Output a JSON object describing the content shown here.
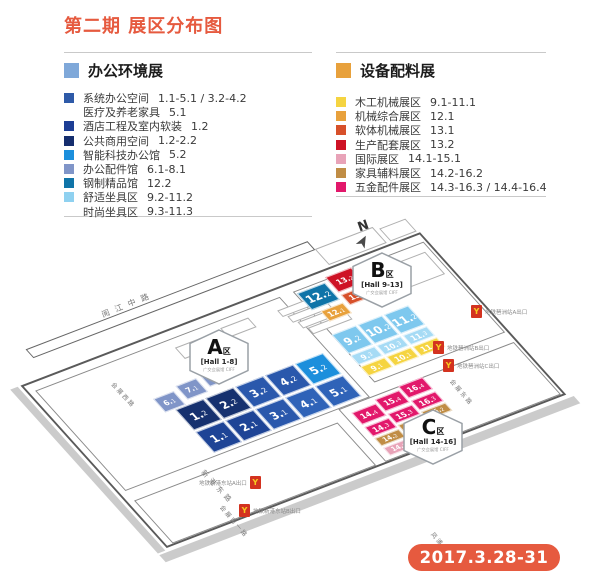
{
  "title": "第二期 展区分布图",
  "accent_color": "#E65A3F",
  "date_badge": "2017.3.28-31",
  "legend_left": {
    "header": "办公环境展",
    "header_color": "#7FA8D9",
    "items": [
      {
        "label": "系统办公空间",
        "range": "1.1-5.1 / 3.2-4.2",
        "color": "#2E5AA8"
      },
      {
        "label": "医疗及养老家具",
        "range": "5.1",
        "color": null
      },
      {
        "label": "酒店工程及室内软装",
        "range": "1.2",
        "color": "#1D3E95"
      },
      {
        "label": "公共商用空间",
        "range": "1.2-2.2",
        "color": "#152E6E"
      },
      {
        "label": "智能科技办公馆",
        "range": "5.2",
        "color": "#1C8FDC"
      },
      {
        "label": "办公配件馆",
        "range": "6.1-8.1",
        "color": "#8095C8"
      },
      {
        "label": "钢制精品馆",
        "range": "12.2",
        "color": "#0F74A8"
      },
      {
        "label": "舒适坐具区",
        "range": "9.2-11.2",
        "color": "#8FD1F0"
      },
      {
        "label": "时尚坐具区",
        "range": "9.3-11.3",
        "color": null
      }
    ]
  },
  "legend_right": {
    "header": "设备配料展",
    "header_color": "#E8A13C",
    "items": [
      {
        "label": "木工机械展区",
        "range": "9.1-11.1",
        "color": "#F5D441"
      },
      {
        "label": "机械综合展区",
        "range": "12.1",
        "color": "#E8A13C"
      },
      {
        "label": "软体机械展区",
        "range": "13.1",
        "color": "#D7502A"
      },
      {
        "label": "生产配套展区",
        "range": "13.2",
        "color": "#CE1225"
      },
      {
        "label": "国际展区",
        "range": "14.1-15.1",
        "color": "#E8A3B8"
      },
      {
        "label": "家具辅料展区",
        "range": "14.2-16.2",
        "color": "#C08D45"
      },
      {
        "label": "五金配件展区",
        "range": "14.3-16.3 / 14.4-16.4",
        "color": "#E2186B"
      }
    ]
  },
  "map": {
    "compass": "N",
    "badges": [
      {
        "letter": "A",
        "region_suffix": "区",
        "hall": "[Hall 1-8]",
        "venue": "广交会展馆 CIFF",
        "x": 188,
        "y": 329
      },
      {
        "letter": "B",
        "region_suffix": "区",
        "hall": "[Hall 9-13]",
        "venue": "广交会展馆 CIFF",
        "x": 351,
        "y": 252
      },
      {
        "letter": "C",
        "region_suffix": "区",
        "hall": "[Hall 14-16]",
        "venue": "广交会展馆 CIFF",
        "x": 402,
        "y": 409
      }
    ],
    "halls": [
      {
        "id": "1.2",
        "x": 106,
        "y": 92,
        "w": 30,
        "h": 26,
        "color": "#16316F"
      },
      {
        "id": "2.2",
        "x": 138,
        "y": 92,
        "w": 30,
        "h": 26,
        "color": "#16316F"
      },
      {
        "id": "3.2",
        "x": 170,
        "y": 92,
        "w": 30,
        "h": 26,
        "color": "#2A58AC"
      },
      {
        "id": "4.2",
        "x": 202,
        "y": 92,
        "w": 30,
        "h": 26,
        "color": "#2A58AC"
      },
      {
        "id": "5.2",
        "x": 234,
        "y": 92,
        "w": 30,
        "h": 26,
        "color": "#1C8FDC"
      },
      {
        "id": "1.1",
        "x": 106,
        "y": 120,
        "w": 30,
        "h": 26,
        "color": "#1E4496"
      },
      {
        "id": "2.1",
        "x": 138,
        "y": 120,
        "w": 30,
        "h": 26,
        "color": "#1E4496"
      },
      {
        "id": "3.1",
        "x": 170,
        "y": 120,
        "w": 30,
        "h": 26,
        "color": "#2A58AC"
      },
      {
        "id": "4.1",
        "x": 202,
        "y": 120,
        "w": 30,
        "h": 26,
        "color": "#2F63B8"
      },
      {
        "id": "5.1",
        "x": 234,
        "y": 120,
        "w": 30,
        "h": 26,
        "color": "#2F63B8"
      },
      {
        "id": "6.1",
        "x": 96,
        "y": 74,
        "w": 22,
        "h": 17,
        "color": "#8095C8"
      },
      {
        "id": "7.1",
        "x": 123,
        "y": 70,
        "w": 22,
        "h": 17,
        "color": "#8095C8"
      },
      {
        "id": "8.1",
        "x": 150,
        "y": 66,
        "w": 22,
        "h": 17,
        "color": "#8095C8"
      },
      {
        "id": "12.2",
        "x": 286,
        "y": 27,
        "w": 30,
        "h": 21,
        "color": "#0F74A8"
      },
      {
        "id": "13.2",
        "x": 320,
        "y": 22,
        "w": 28,
        "h": 19,
        "color": "#CE1225"
      },
      {
        "id": "12.1",
        "x": 292,
        "y": 52,
        "w": 24,
        "h": 13,
        "color": "#E8A13C"
      },
      {
        "id": "13.1",
        "x": 320,
        "y": 44,
        "w": 26,
        "h": 13,
        "color": "#D7502A"
      },
      {
        "id": "9.2",
        "x": 284,
        "y": 78,
        "w": 26,
        "h": 24,
        "color": "#7EC8EE"
      },
      {
        "id": "10.2",
        "x": 312,
        "y": 78,
        "w": 26,
        "h": 24,
        "color": "#7EC8EE"
      },
      {
        "id": "11.2",
        "x": 340,
        "y": 78,
        "w": 26,
        "h": 24,
        "color": "#7EC8EE"
      },
      {
        "id": "9.3",
        "x": 284,
        "y": 104,
        "w": 26,
        "h": 12,
        "color": "#A6DBF5"
      },
      {
        "id": "10.3",
        "x": 312,
        "y": 104,
        "w": 26,
        "h": 12,
        "color": "#A6DBF5"
      },
      {
        "id": "11.3",
        "x": 340,
        "y": 104,
        "w": 26,
        "h": 12,
        "color": "#A6DBF5"
      },
      {
        "id": "9.1",
        "x": 284,
        "y": 118,
        "w": 26,
        "h": 12,
        "color": "#F5D441"
      },
      {
        "id": "10.1",
        "x": 312,
        "y": 118,
        "w": 26,
        "h": 12,
        "color": "#F5D441"
      },
      {
        "id": "11.1",
        "x": 340,
        "y": 118,
        "w": 26,
        "h": 12,
        "color": "#F5D441"
      },
      {
        "id": "14.4",
        "x": 244,
        "y": 158,
        "w": 26,
        "h": 15,
        "color": "#E2186B"
      },
      {
        "id": "15.4",
        "x": 272,
        "y": 154,
        "w": 26,
        "h": 15,
        "color": "#E2186B"
      },
      {
        "id": "16.4",
        "x": 300,
        "y": 150,
        "w": 26,
        "h": 15,
        "color": "#E2186B"
      },
      {
        "id": "14.3",
        "x": 244,
        "y": 176,
        "w": 26,
        "h": 12,
        "color": "#E2186B"
      },
      {
        "id": "15.3",
        "x": 272,
        "y": 172,
        "w": 26,
        "h": 12,
        "color": "#E2186B"
      },
      {
        "id": "16.3",
        "x": 300,
        "y": 168,
        "w": 26,
        "h": 12,
        "color": "#E2186B"
      },
      {
        "id": "14.2",
        "x": 244,
        "y": 190,
        "w": 26,
        "h": 10,
        "color": "#C08D45"
      },
      {
        "id": "15.2",
        "x": 272,
        "y": 186,
        "w": 26,
        "h": 10,
        "color": "#C08D45"
      },
      {
        "id": "16.2",
        "x": 300,
        "y": 182,
        "w": 26,
        "h": 10,
        "color": "#C08D45"
      },
      {
        "id": "14.1",
        "x": 244,
        "y": 202,
        "w": 26,
        "h": 10,
        "color": "#E8A3B8"
      },
      {
        "id": "15.1",
        "x": 272,
        "y": 198,
        "w": 26,
        "h": 10,
        "color": "#E8A3B8"
      }
    ],
    "streets": [
      {
        "name": "阅江中路",
        "x": 100,
        "y": 310,
        "rot": -22,
        "size": 8,
        "ls": 6
      },
      {
        "name": "新港东路",
        "x": 206,
        "y": 468,
        "rot": 47,
        "size": 7,
        "ls": 4
      },
      {
        "name": "会展南一路",
        "x": 225,
        "y": 503,
        "rot": 50,
        "size": 6,
        "ls": 2
      },
      {
        "name": "会展东路",
        "x": 455,
        "y": 377,
        "rot": 50,
        "size": 6,
        "ls": 2
      },
      {
        "name": "凤浦中路",
        "x": 436,
        "y": 530,
        "rot": 50,
        "size": 6,
        "ls": 2
      },
      {
        "name": "会展西路",
        "x": 116,
        "y": 380,
        "rot": 47,
        "size": 6,
        "ls": 2
      }
    ],
    "metro_exits": [
      {
        "label": "地铁琶洲站A出口",
        "x": 471,
        "y": 305,
        "side": "right"
      },
      {
        "label": "地铁琶洲站B出口",
        "x": 433,
        "y": 341,
        "side": "right"
      },
      {
        "label": "地铁琶洲站C出口",
        "x": 443,
        "y": 359,
        "side": "right"
      },
      {
        "label": "地铁新港东站A出口",
        "x": 199,
        "y": 476,
        "side": "left"
      },
      {
        "label": "地铁新港东站B出口",
        "x": 239,
        "y": 504,
        "side": "right"
      }
    ]
  }
}
